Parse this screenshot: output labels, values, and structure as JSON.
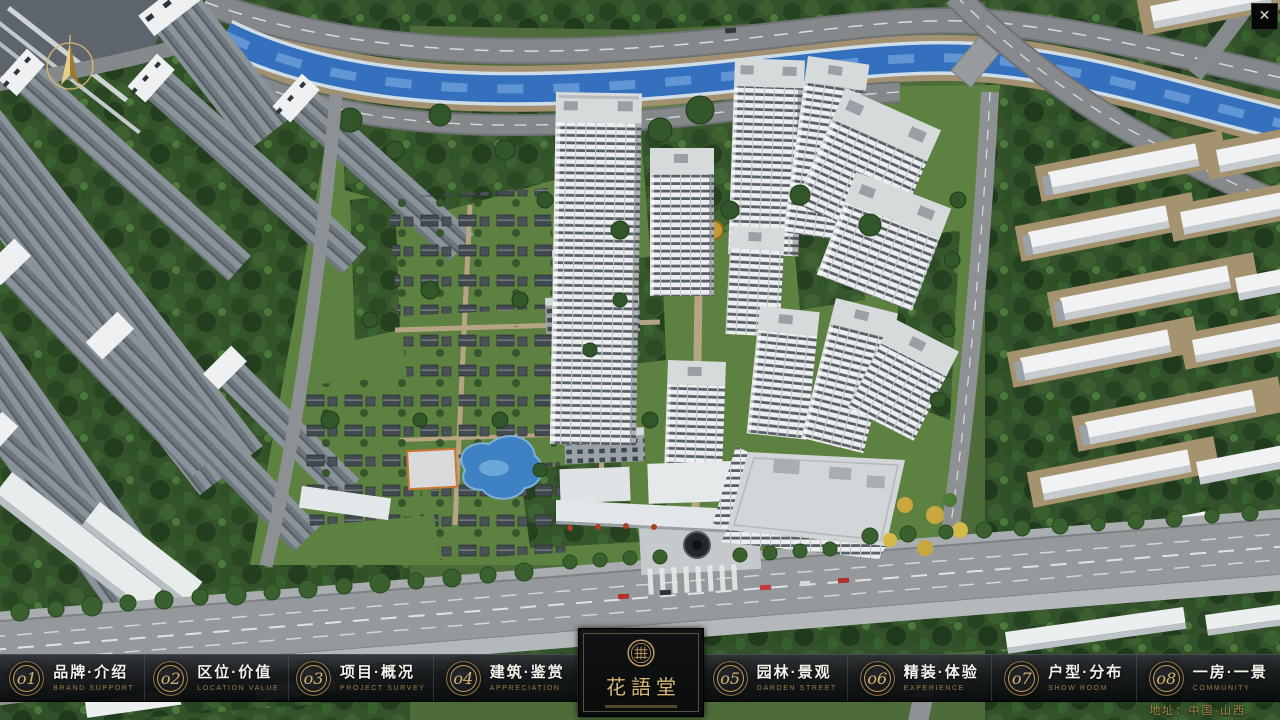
{
  "window": {
    "icons": {
      "close": "✕",
      "compass": "north-arrow"
    }
  },
  "nav": {
    "items": [
      {
        "num": "o1",
        "cn": "品牌·介绍",
        "en": "BRAND SUPPORT"
      },
      {
        "num": "o2",
        "cn": "区位·价值",
        "en": "LOCATION VALUE"
      },
      {
        "num": "o3",
        "cn": "项目·概况",
        "en": "PROJECT SURVEY"
      },
      {
        "num": "o4",
        "cn": "建筑·鉴赏",
        "en": "APPRECIATION"
      },
      {
        "num": "o5",
        "cn": "园林·景观",
        "en": "GARDEN STREET"
      },
      {
        "num": "o6",
        "cn": "精装·体验",
        "en": "EXPERIENCE"
      },
      {
        "num": "o7",
        "cn": "户型·分布",
        "en": "SHOW ROOM"
      },
      {
        "num": "o8",
        "cn": "一房·一景",
        "en": "COMMUNITY"
      }
    ]
  },
  "logo": {
    "cn": "花語堂"
  },
  "footer": {
    "address": "地址：中国·山西"
  },
  "colors": {
    "accent_gold": "#c9a368",
    "nav_bg": "#17191b",
    "nav_text": "#f2f2ea",
    "nav_subtext": "#9a7c48",
    "river_blue": "#3873c2",
    "foliage_green": "#33512a",
    "building_white": "#eceeef",
    "road_gray": "#85888b"
  }
}
